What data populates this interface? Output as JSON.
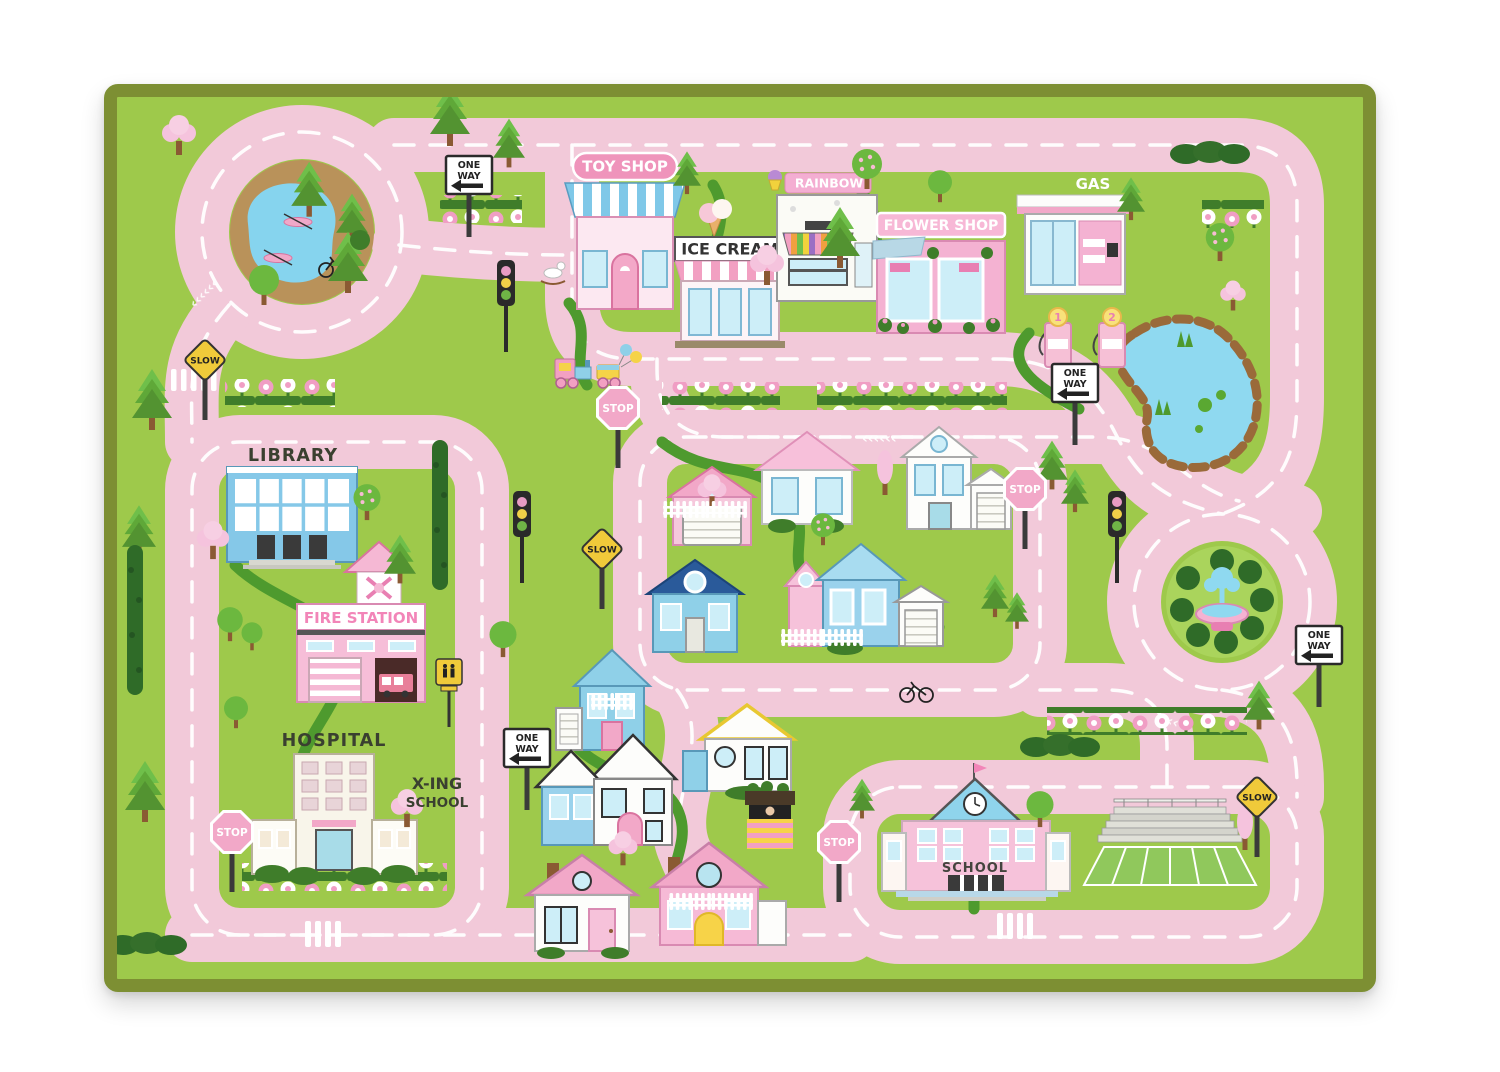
{
  "rug": {
    "colors": {
      "grass": "#9ec94b",
      "road": "#f2c9d9",
      "road_line": "#ffffff",
      "binding_border": "#7d8f33",
      "walkway": "#4e9a2e",
      "water": "#8fd9f0",
      "sign_pink": "#f2a8c8",
      "sign_yellow": "#f0ca3a"
    },
    "buildings": {
      "toy_shop": {
        "label": "TOY SHOP"
      },
      "ice_cream": {
        "label": "ICE CREAM"
      },
      "rainbow": {
        "label": "RAINBOW"
      },
      "flower_shop": {
        "label": "FLOWER SHOP"
      },
      "gas_station": {
        "label": "GAS",
        "pump_1": "1",
        "pump_2": "2"
      },
      "library": {
        "label": "LIBRARY"
      },
      "fire_station": {
        "label": "FIRE STATION"
      },
      "hospital": {
        "label": "HOSPITAL"
      },
      "school": {
        "label": "SCHOOL"
      }
    },
    "signs": {
      "stop": "STOP",
      "slow": "SLOW",
      "one_way_line1": "ONE",
      "one_way_line2": "WAY",
      "school_xing_line1": "X-ING",
      "school_xing_line2": "SCHOOL"
    },
    "decor": {
      "chevrons": "‹‹‹‹‹‹"
    }
  }
}
